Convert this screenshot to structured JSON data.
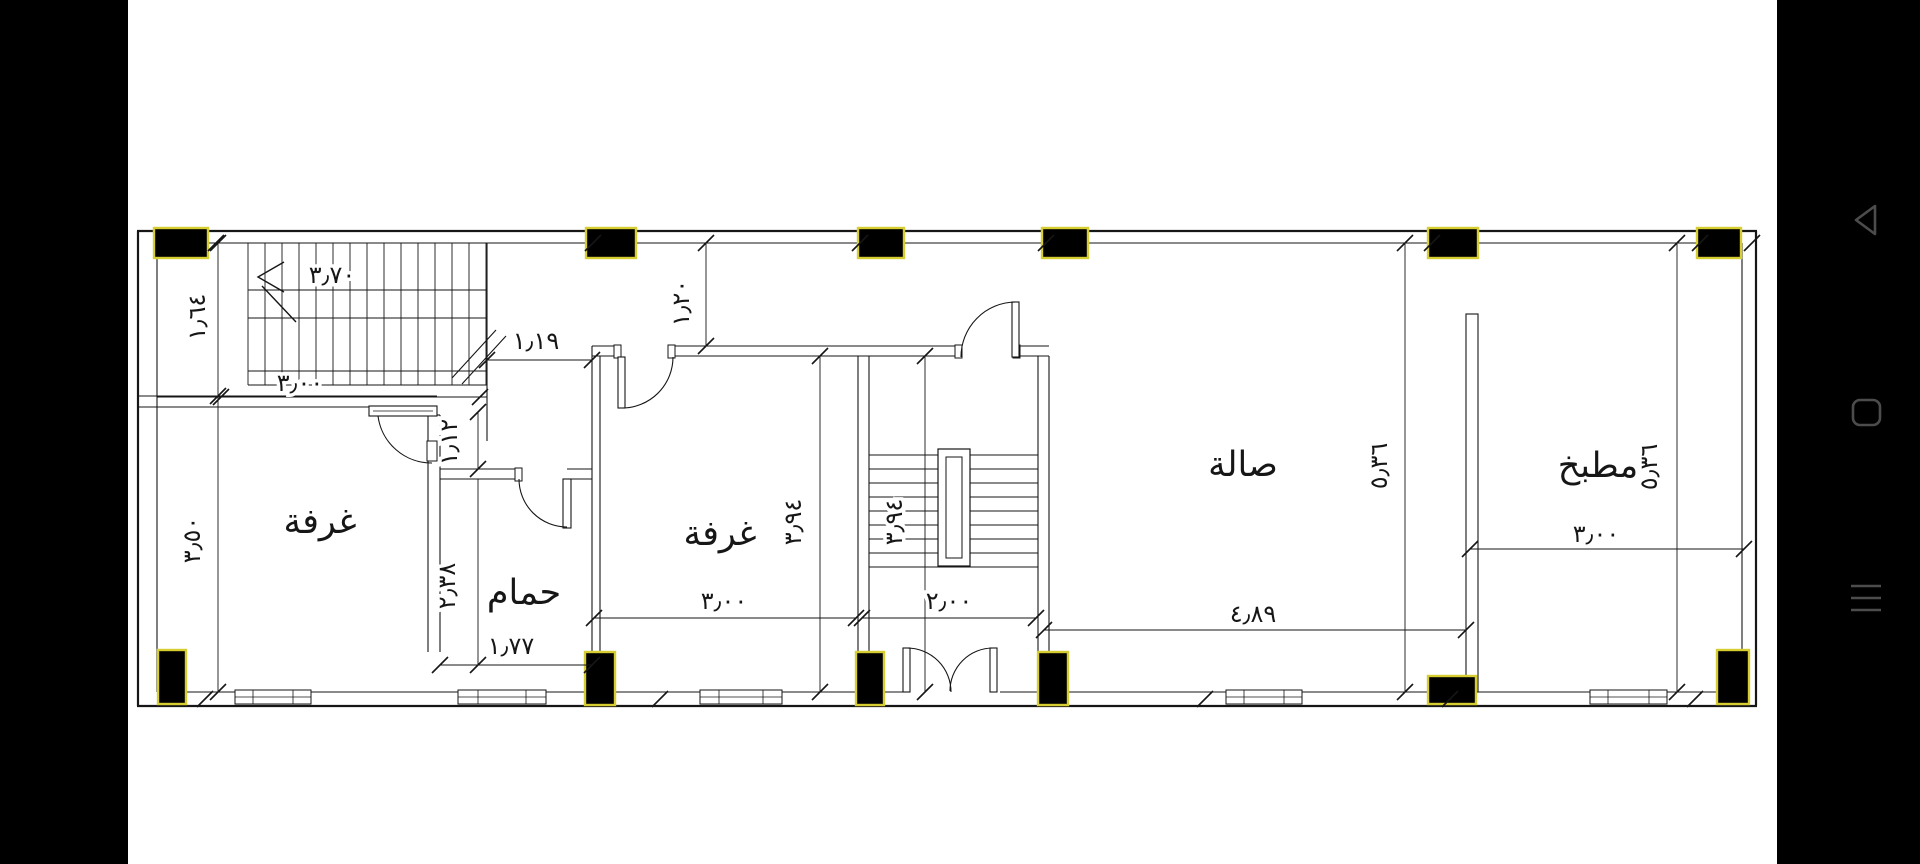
{
  "device": {
    "nav": {
      "back_label": "back",
      "recents_label": "recents",
      "menu_label": "menu"
    },
    "bar_color": "#000000",
    "nav_icon_color": "#4c4c4c"
  },
  "plan": {
    "type": "apartment-floor-plan",
    "room_labels": {
      "bedroom1": "غرفة",
      "bedroom2": "غرفة",
      "bathroom": "حمام",
      "hall": "صالة",
      "kitchen": "مطبخ"
    },
    "dimensions": {
      "stairs_width": "٣٫٧٠",
      "entry_depth": "١٫٦٤",
      "room1_width": "٣٫٠٠",
      "room1_height": "٣٫٥٠",
      "corridor_length": "١٫١٩",
      "top_strip": "١٫٢٠",
      "corridor_width": "١٫١٢",
      "bathroom_height": "٢٫٣٨",
      "bathroom_width": "١٫٧٧",
      "room2_width": "٣٫٠٠",
      "room2_height": "٣٫٩٤",
      "stairwell_width": "٢٫٠٠",
      "stairwell_height": "٣٫٩٤",
      "hall_width": "٤٫٨٩",
      "hall_height": "٥٫٣٦",
      "kitchen_width": "٣٫٠٠",
      "kitchen_height": "٥٫٣٦"
    },
    "colors": {
      "line": "#161616",
      "column_fill": "#000000",
      "column_outline": "#d6cd31",
      "background": "#ffffff"
    }
  }
}
